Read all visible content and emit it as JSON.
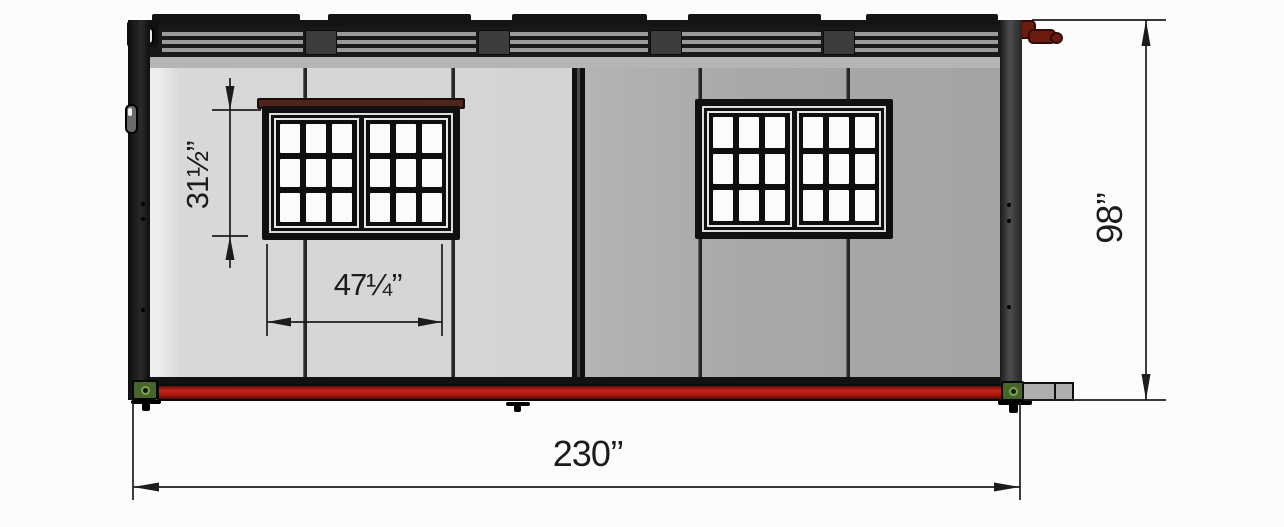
{
  "title": "Foldable container house - front elevation drawing",
  "dimensions": {
    "window_height_label": "31½’’",
    "window_width_label": "47¼’’",
    "overall_height_label": "98’’",
    "overall_width_label": "230’’"
  },
  "building": {
    "wall_left_color": "#d8d8d8",
    "wall_right_color": "#a8a8a8",
    "base_rail_color": "#b01c10",
    "corner_fitting_color": "#47652a",
    "window_cap_color": "#4f241c",
    "hinge_color": "#6b1c0f",
    "window_grid": {
      "sashes": 2,
      "cols": 3,
      "rows": 3
    },
    "windows": [
      {
        "id": "left-window"
      },
      {
        "id": "right-window"
      }
    ]
  }
}
